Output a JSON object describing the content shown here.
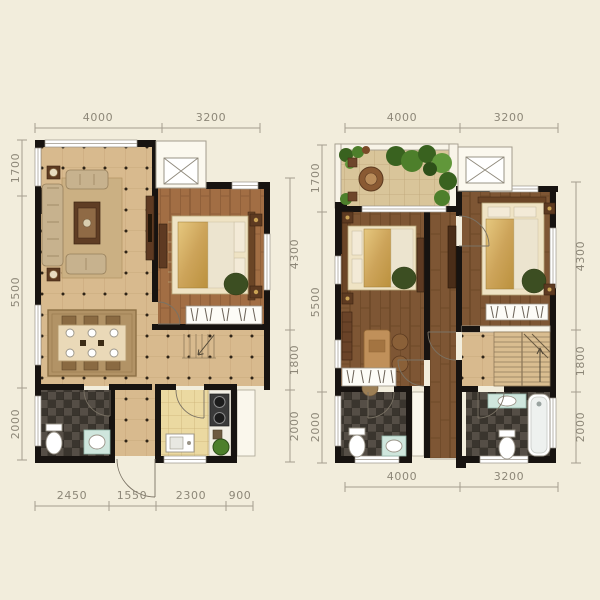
{
  "title": "two-storey-apartment-floor-plan",
  "colors": {
    "background": "#f2eddc",
    "wall": "#171310",
    "dim_line": "#a49d8e",
    "dim_text": "#8d8778",
    "tile_floor": "#d8ba8e",
    "wood_floor_first": "#a26e44",
    "wood_floor_second": "#7e5634",
    "bath_tile": "#4a443b",
    "kitchen_tile": "#ebd9a1",
    "terrace_tile": "#d9c59a",
    "bedding_gold": "#cda45a",
    "plant_green": "#4d7f2b",
    "fixture_teal": "#cfe6dd"
  },
  "floor1": {
    "name": "first-floor-plan",
    "dims": {
      "top": [
        "4000",
        "3200"
      ],
      "left": [
        "1700",
        "5500",
        "2000"
      ],
      "right": [
        "4300",
        "1800",
        "2000"
      ],
      "bottom": [
        "2450",
        "1550",
        "2300",
        "900"
      ]
    }
  },
  "floor2": {
    "name": "second-floor-plan",
    "dims": {
      "top": [
        "4000",
        "3200"
      ],
      "left": [
        "1700",
        "5500",
        "2000"
      ],
      "right": [
        "4300",
        "1800",
        "2000"
      ],
      "bottom": [
        "4000",
        "3200"
      ]
    }
  }
}
